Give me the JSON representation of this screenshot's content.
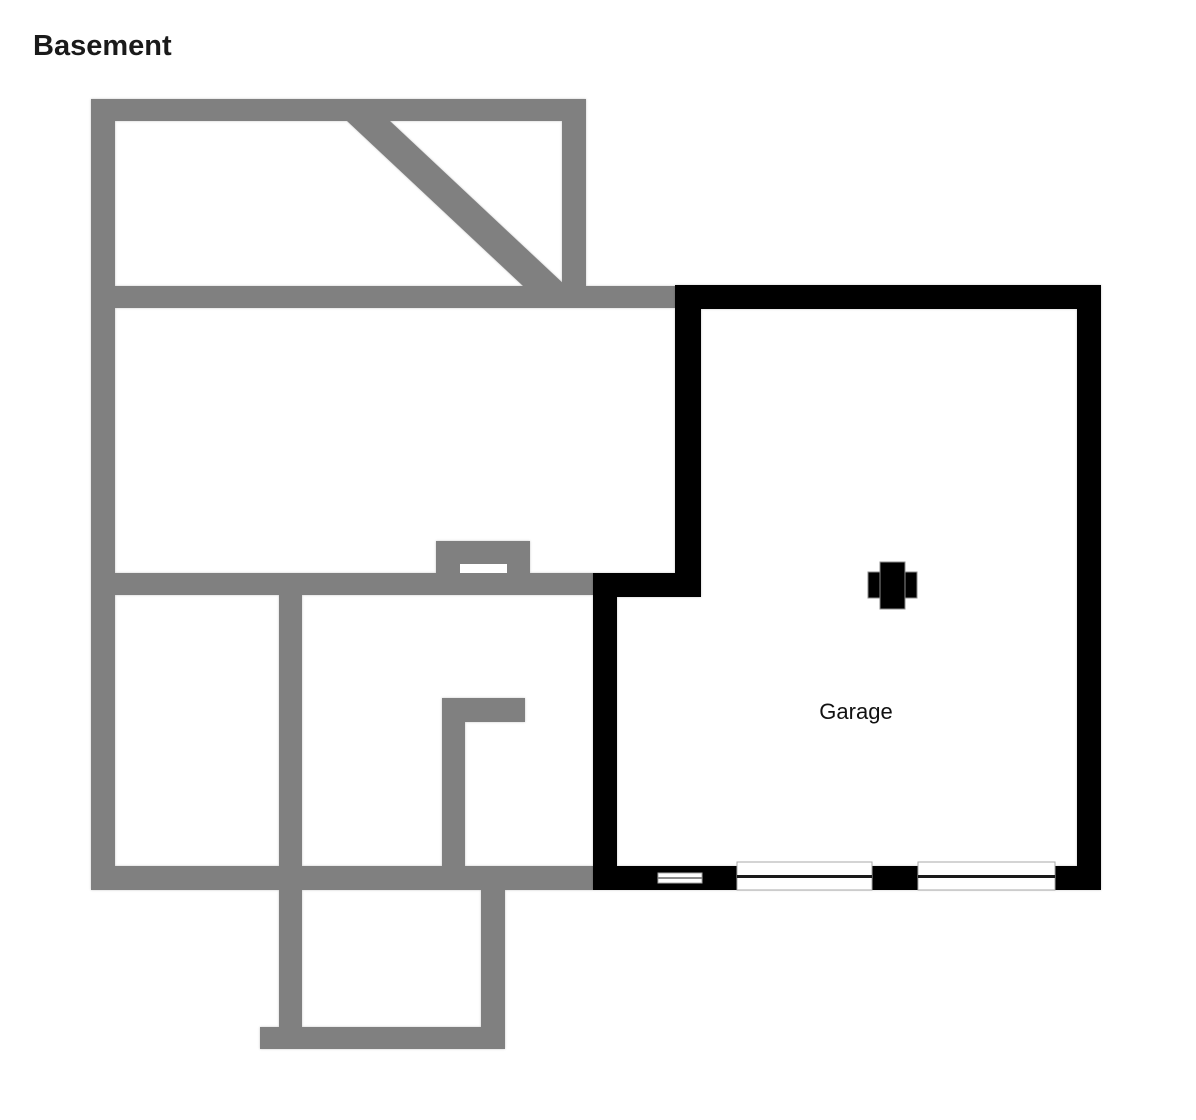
{
  "labels": {
    "title": "Basement",
    "garage": "Garage"
  },
  "colors": {
    "background": "#ffffff",
    "basement_wall": "#808080",
    "garage_wall": "#000000",
    "opening_fill": "#ffffff",
    "opening_border": "#a8a8a8",
    "window_bar": "#1a1a1a",
    "small_window_bar": "#8c8c8c",
    "column_fill": "#000000",
    "column_border": "#8c8c8c",
    "text": "#1a1a1a"
  },
  "floorplan": {
    "canvas": {
      "width": 1196,
      "height": 1120
    },
    "basement_walls": [
      {
        "name": "left-wall",
        "x": 91,
        "y": 99,
        "w": 24,
        "h": 791
      },
      {
        "name": "top-wall",
        "x": 91,
        "y": 99,
        "w": 495,
        "h": 22
      },
      {
        "name": "top-room-right-wall",
        "x": 562,
        "y": 99,
        "w": 24,
        "h": 187
      },
      {
        "name": "upper-mid-wall",
        "x": 91,
        "y": 286,
        "w": 584,
        "h": 22
      },
      {
        "name": "mid-wall",
        "x": 91,
        "y": 573,
        "w": 502,
        "h": 22
      },
      {
        "name": "chimney-bump",
        "x": 436,
        "y": 541,
        "w": 94,
        "h": 32
      },
      {
        "name": "room-divider-wall",
        "x": 279,
        "y": 573,
        "w": 23,
        "h": 317
      },
      {
        "name": "l-wall-horizontal",
        "x": 442,
        "y": 698,
        "w": 83,
        "h": 24
      },
      {
        "name": "l-wall-vertical",
        "x": 442,
        "y": 722,
        "w": 23,
        "h": 168
      },
      {
        "name": "bottom-wall",
        "x": 91,
        "y": 866,
        "w": 502,
        "h": 24
      },
      {
        "name": "stair-extension-left-wall",
        "x": 279,
        "y": 890,
        "w": 23,
        "h": 137
      },
      {
        "name": "stair-extension-bottom-wall",
        "x": 260,
        "y": 1027,
        "w": 245,
        "h": 22
      },
      {
        "name": "stair-extension-right-wall",
        "x": 481,
        "y": 890,
        "w": 24,
        "h": 137
      }
    ],
    "basement_diagonal": {
      "name": "diagonal-wall",
      "points": "347,121 390,121 566,286 523,286"
    },
    "basement_opening": {
      "name": "chimney-slot-opening",
      "x": 460,
      "y": 564,
      "w": 47,
      "h": 9
    },
    "garage_walls": [
      {
        "name": "garage-top-wall",
        "x": 675,
        "y": 285,
        "w": 426,
        "h": 24
      },
      {
        "name": "garage-left-upper-wall",
        "x": 675,
        "y": 285,
        "w": 26,
        "h": 312
      },
      {
        "name": "garage-jog-wall",
        "x": 593,
        "y": 573,
        "w": 108,
        "h": 24
      },
      {
        "name": "garage-left-lower-wall",
        "x": 593,
        "y": 573,
        "w": 24,
        "h": 317
      },
      {
        "name": "garage-bottom-wall",
        "x": 593,
        "y": 866,
        "w": 508,
        "h": 24
      },
      {
        "name": "garage-right-wall",
        "x": 1077,
        "y": 285,
        "w": 24,
        "h": 605
      }
    ],
    "garage_windows": [
      {
        "name": "garage-small-window",
        "x": 658,
        "y": 873,
        "w": 44,
        "h": 10,
        "bar": 2,
        "bar_color_key": "small_window_bar"
      },
      {
        "name": "garage-window-left",
        "x": 737,
        "y": 862,
        "w": 135,
        "h": 28,
        "bar": 3,
        "bar_color_key": "window_bar"
      },
      {
        "name": "garage-window-right",
        "x": 918,
        "y": 862,
        "w": 137,
        "h": 28,
        "bar": 3,
        "bar_color_key": "window_bar"
      }
    ],
    "garage_column": {
      "left_flange": {
        "name": "column-left-flange",
        "x": 868,
        "y": 572,
        "w": 12,
        "h": 26
      },
      "right_flange": {
        "name": "column-right-flange",
        "x": 905,
        "y": 572,
        "w": 12,
        "h": 26
      },
      "center": {
        "name": "column-center-post",
        "x": 880,
        "y": 562,
        "w": 25,
        "h": 47
      }
    },
    "garage_label_anchor": {
      "x": 856,
      "y": 712
    }
  }
}
